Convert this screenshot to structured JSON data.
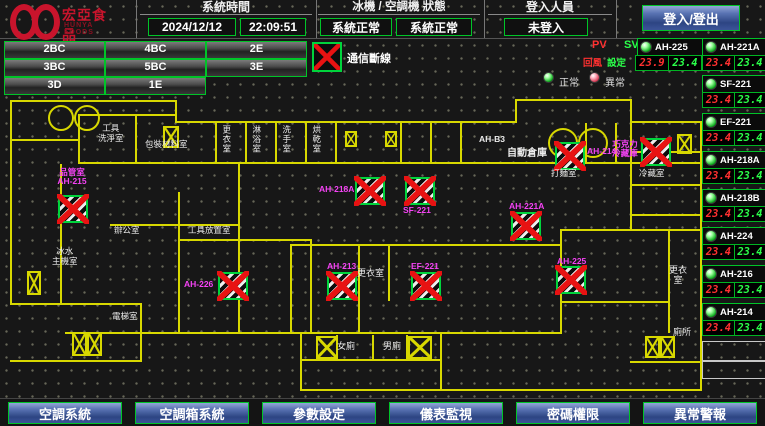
{
  "header": {
    "logo": {
      "cn": "宏亞食品",
      "en": "HUNYA FOODS"
    },
    "time_section": {
      "label": "系統時間",
      "date": "2024/12/12",
      "time": "22:09:51"
    },
    "status_section": {
      "label": "冰機 / 空調機 狀態",
      "chiller": "系統正常",
      "ahu": "系統正常"
    },
    "login_section": {
      "label": "登入人員",
      "user": "未登入",
      "button": "登入/登出"
    }
  },
  "floors": [
    "2BC",
    "4BC",
    "2E",
    "3BC",
    "5BC",
    "3E",
    "3D",
    "1E"
  ],
  "legend": {
    "comm_offline": "通信斷線",
    "pv": "PV",
    "sv": "SV",
    "pv_type": "回風",
    "sv_type": "設定",
    "normal": "正常",
    "abnormal": "異常"
  },
  "colors": {
    "accent_green": "#00c428",
    "alarm_red": "#ff3030",
    "setpoint_green": "#2bff4a",
    "wall_yellow": "#d8d800",
    "label_magenta": "#f643f6",
    "button_blue": "#3c5498"
  },
  "units": [
    {
      "name": "AH-225",
      "pv": "23.9",
      "sv": "23.4"
    },
    {
      "name": "AH-221A",
      "pv": "23.4",
      "sv": "23.4"
    },
    {
      "name": "SF-221",
      "pv": "23.4",
      "sv": "23.4"
    },
    {
      "name": "EF-221",
      "pv": "23.4",
      "sv": "23.4"
    },
    {
      "name": "AH-218A",
      "pv": "23.4",
      "sv": "23.4"
    },
    {
      "name": "AH-218B",
      "pv": "23.4",
      "sv": "23.4"
    },
    {
      "name": "AH-224",
      "pv": "23.4",
      "sv": "23.4"
    },
    {
      "name": "AH-216",
      "pv": "23.4",
      "sv": "23.4"
    },
    {
      "name": "AH-214",
      "pv": "23.4",
      "sv": "23.4"
    }
  ],
  "map": {
    "devices": [
      "品管室\nAH-215",
      "AH-226",
      "AH-218A",
      "SF-221",
      "AH-221A",
      "AH-214",
      "巧克力\n冷藏庫",
      "AH-213",
      "EF-221",
      "AH-225"
    ],
    "rooms": [
      "工具\n洗淨室",
      "包裝材料室",
      "更衣室",
      "淋浴室",
      "洗手室",
      "烘乾室",
      "AH-B3",
      "自動倉庫",
      "辦公室",
      "工具放置室",
      "更衣室",
      "女廁",
      "男廁",
      "更衣\n室",
      "廁所",
      "冰水\n主機室",
      "電梯室",
      "打麵室",
      "冷藏室"
    ]
  },
  "nav": [
    "空調系統",
    "空調箱系統",
    "參數設定",
    "儀表監視",
    "密碼權限",
    "異常警報"
  ]
}
